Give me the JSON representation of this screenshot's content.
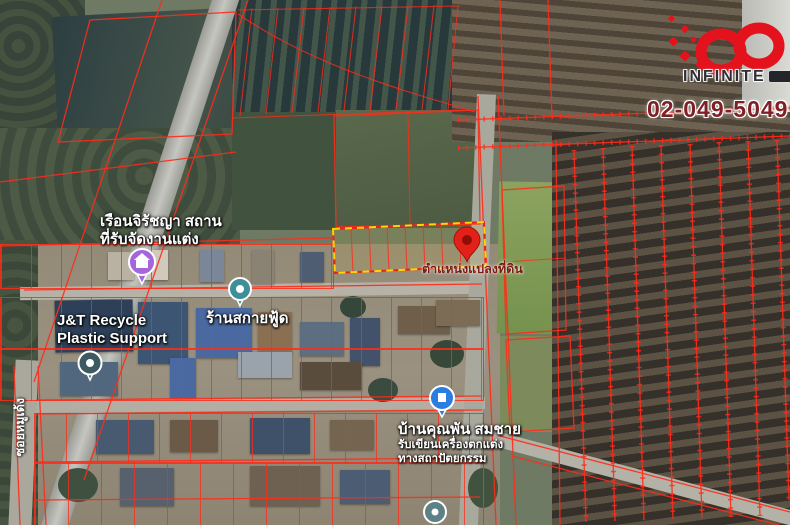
{
  "branding": {
    "logo_name": "INFINITE",
    "phone": "02-049-5049",
    "accent_red": "#e4121c",
    "phone_color": "#7d2127"
  },
  "map_labels": {
    "venue_line1": "เรือนจิรัชญา สถาน",
    "venue_line2": "ที่รับจัดงานแต่ง",
    "jt_line1": "J&T Recycle",
    "jt_line2": "Plastic Support",
    "skyfood": "ร้านสกายฟู้ด",
    "house_line1": "บ้านคุณพัน สมชาย",
    "house_line2": "รับเขียนเครื่องตกแต่ง",
    "house_line3": "ทางสถาปัตยกรรม",
    "parcel_location": "ตำแหน่งแปลงที่ดิน",
    "soi": "ซอยหมูเด้ง"
  },
  "highlight": {
    "dash_color": "#ffd400",
    "parcel_line_color": "#ff2b1a"
  },
  "pins": {
    "red_pin": "target land parcel",
    "purple_pin": "wedding venue",
    "teal_pin_1": "J&T Recycle shop",
    "teal_pin_2": "Sky Food shop",
    "blue_pin": "architecture house",
    "gray_pin": "POI"
  }
}
